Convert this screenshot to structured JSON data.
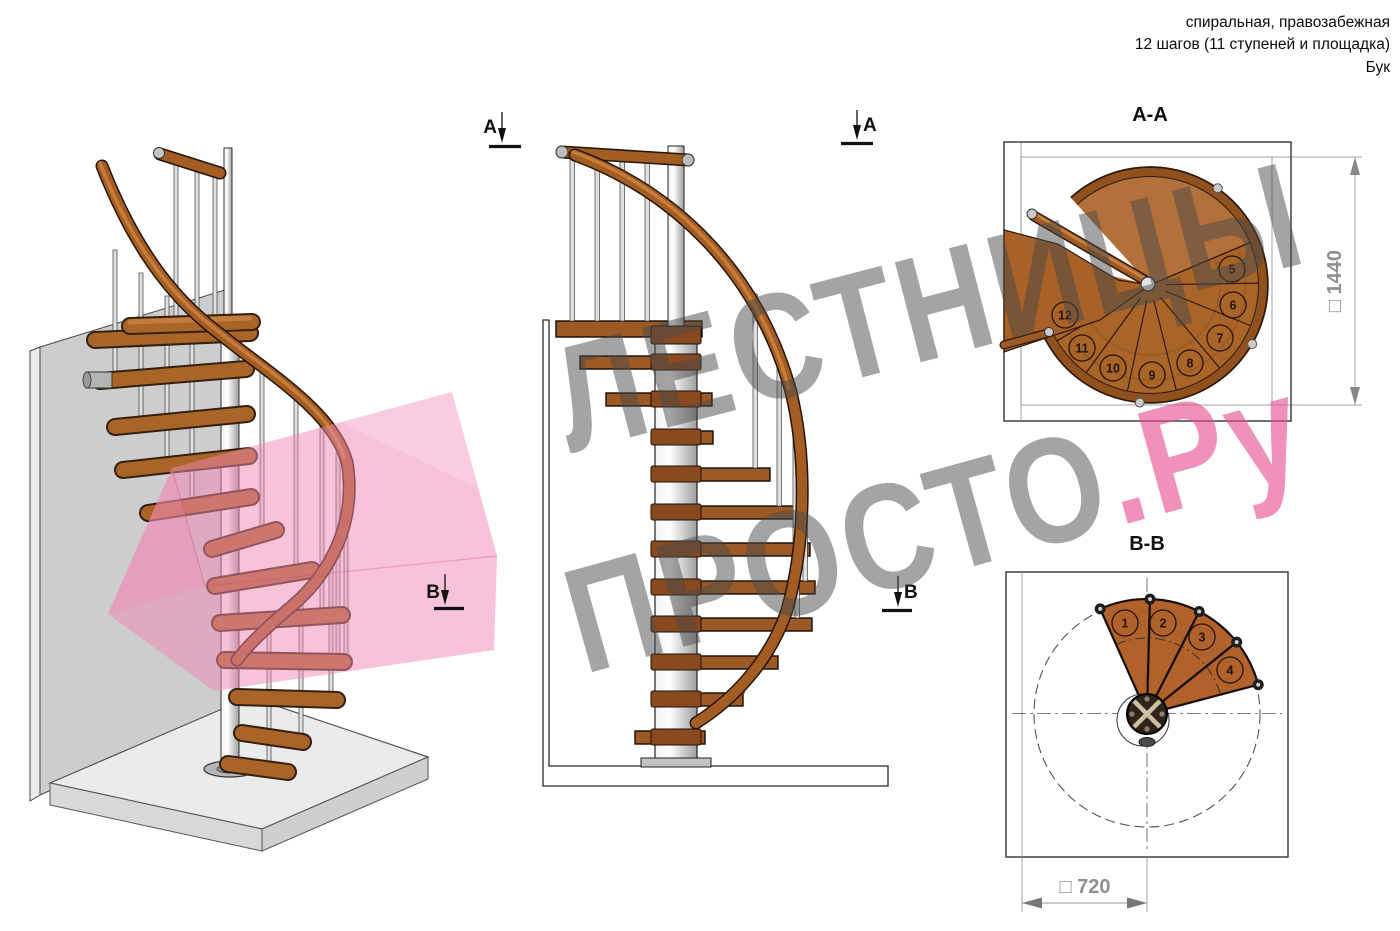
{
  "header": {
    "line1": "спиральная, правозабежная",
    "line2": "12 шагов (11 ступеней и площадка)",
    "line3": "Бук"
  },
  "watermark": {
    "line1": "ЛЕСТНИЦЫ",
    "line2_gray": "ПРОСТО",
    "line2_pink": ".Ру"
  },
  "markers": {
    "a": "А",
    "b": "В"
  },
  "views": {
    "aa": {
      "title": "А-А",
      "steps": [
        "5",
        "6",
        "7",
        "8",
        "9",
        "10",
        "11",
        "12"
      ],
      "dimension": "□ 1440"
    },
    "bb": {
      "title": "В-В",
      "steps": [
        "1",
        "2",
        "3",
        "4"
      ],
      "dimension": "□ 720"
    }
  },
  "colors": {
    "wood": "#a96428",
    "wood_dark": "#7a431a",
    "metal": "#d9d9d9",
    "pink_accent": "#ee8fb2",
    "section_plane_pink": "#f28ab1",
    "watermark_gray": "#a3a3a3"
  }
}
